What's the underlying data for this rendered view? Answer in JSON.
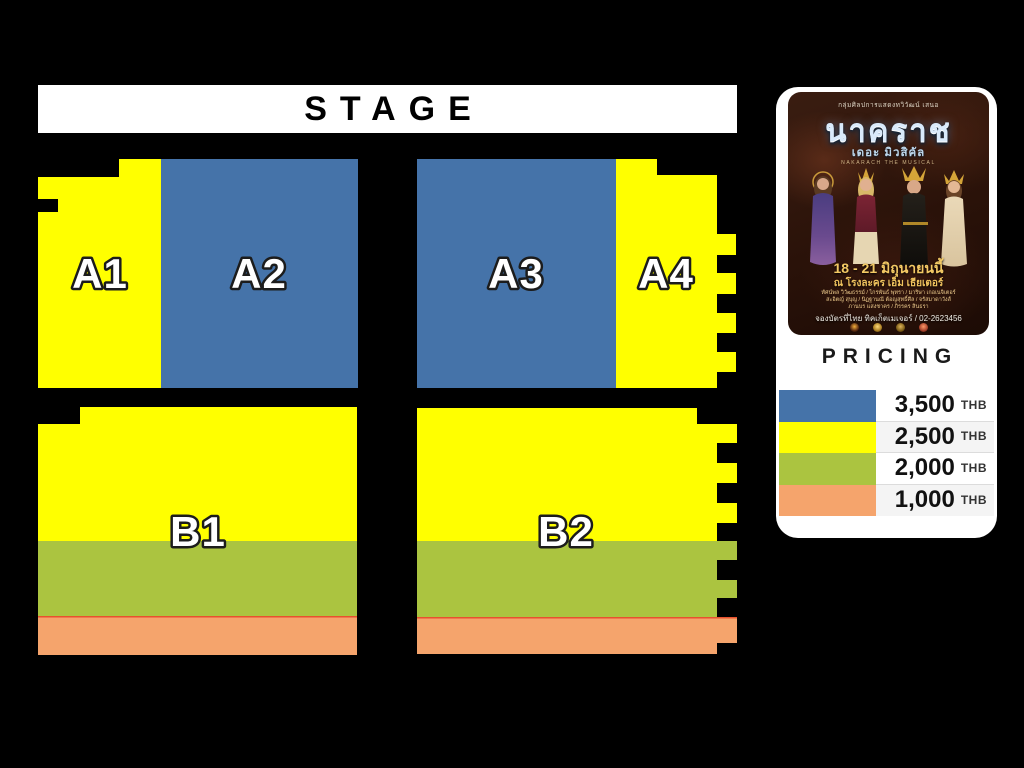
{
  "stage": {
    "label": "STAGE"
  },
  "colors": {
    "background": "#000000",
    "panel": "#ffffff",
    "price_3500": "#4573a9",
    "price_2500": "#ffff00",
    "price_2000": "#abc440",
    "price_1000": "#f5a46c",
    "orange_divider": "#e8512e"
  },
  "seating": {
    "sections": [
      {
        "id": "A1",
        "label": "A1"
      },
      {
        "id": "A2",
        "label": "A2"
      },
      {
        "id": "A3",
        "label": "A3"
      },
      {
        "id": "A4",
        "label": "A4"
      },
      {
        "id": "B1",
        "label": "B1"
      },
      {
        "id": "B2",
        "label": "B2"
      }
    ]
  },
  "pricing": {
    "title": "PRICING",
    "rows": [
      {
        "price": "3,500",
        "currency": "THB"
      },
      {
        "price": "2,500",
        "currency": "THB"
      },
      {
        "price": "2,000",
        "currency": "THB"
      },
      {
        "price": "1,000",
        "currency": "THB"
      }
    ]
  },
  "poster": {
    "presenter": "กลุ่มศิลปการแสดงทวิวัฒน์ เสนอ",
    "title": "นาคราช",
    "subtitle": "เดอะ มิวสิคัล",
    "title_en": "NAKARACH THE MUSICAL",
    "dates": "18 - 21 มิถุนายนนี้",
    "venue": "ณ โรงละคร เอ็ม เธียเตอร์",
    "cast_lines": [
      "ทัศน์พล วิวัฒธรรม์ / ไกรพันธ์ พุทรา / มาริษา เกอเนจิเตอร์",
      "สะอิตญ์ สุบุญ / นิฏฐานณี ต้อญสุทธิ์ศีล / จรัสมาดาวังส์",
      "ภานบร แสงชาคร / ภิรรคร สินธรา"
    ],
    "booking": "จองบัตรที่ไทย ทิคเก็ตเมเจอร์ / 02-2623456"
  }
}
